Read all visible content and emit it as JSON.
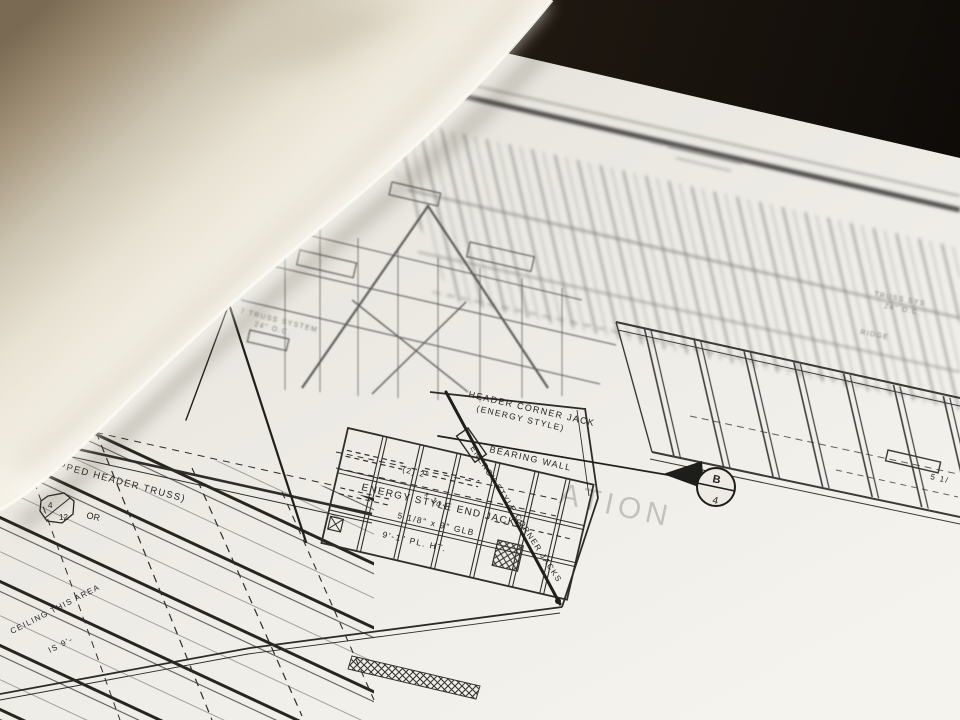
{
  "annotations": {
    "stepped_header_truss": "(STEPPED HEADER TRUSS)",
    "header_corner_jack_line1": "HEADER CORNER JACK",
    "header_corner_jack_line2": "(ENERGY STYLE)",
    "bearing_wall": "BEARING WALL",
    "energy_style_end_jacks": "ENERGY STYLE END JACKS",
    "glb_beam": "5 1/8\" x 9\" GLB",
    "plate_height": "9'-1\" PL. HT.",
    "ceiling_line1": "CEILING THIS AREA",
    "ceiling_line2": "IS 9'-",
    "double_2x10": "(2) 2\"",
    "double_2x10_size": "x 10\"",
    "energy_style_corner_jacks": "ENERGY STYLE CORNER JACKS",
    "truss_system_line1": "7 TRUSS SYSTEM",
    "truss_system_line2": "24\" O.C.",
    "right_truss_line1": "TRUSS SYS",
    "right_truss_line2": "24\" O.C.",
    "ridge": "RIDGE",
    "right_edge_dim": "5 1/",
    "pitch_or": "OR"
  },
  "markers": {
    "section_bubble_top": "B",
    "section_bubble_bottom": "4",
    "roof_pitch_rise": "4",
    "roof_pitch_run": "12"
  },
  "watermark": "ATION",
  "colors": {
    "paper": "#efede6",
    "ink": "#26261f",
    "faded_ink": "#6f6f6f",
    "background": "#15100b",
    "table_tan": "#7d6b54",
    "curl_highlight": "#f7f4ec"
  }
}
